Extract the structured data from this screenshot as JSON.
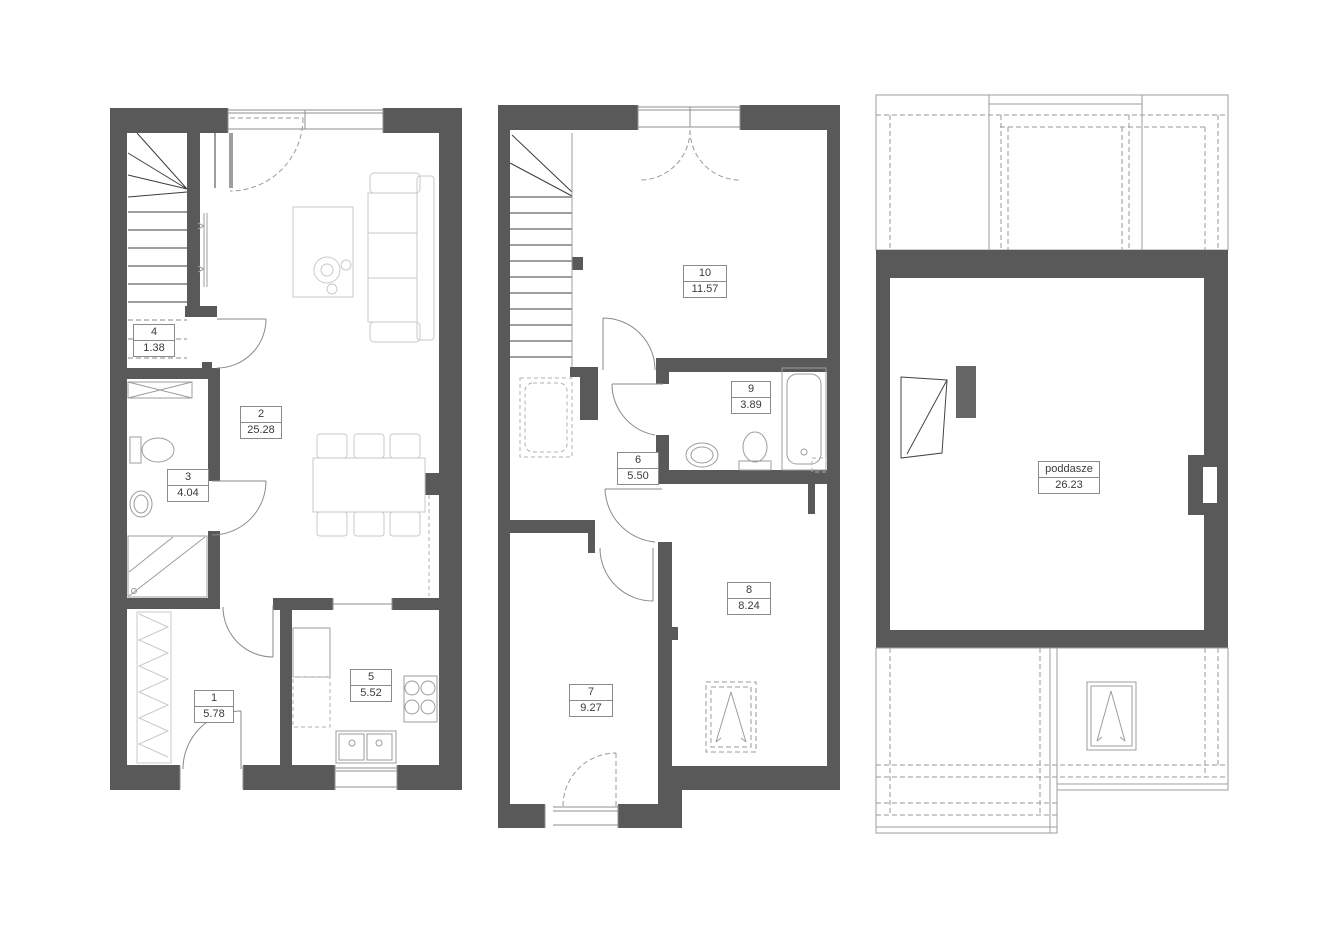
{
  "floors": {
    "ground": {
      "rooms": [
        {
          "id": "1",
          "area": "5.78"
        },
        {
          "id": "2",
          "area": "25.28"
        },
        {
          "id": "3",
          "area": "4.04"
        },
        {
          "id": "4",
          "area": "1.38"
        },
        {
          "id": "5",
          "area": "5.52"
        }
      ]
    },
    "first": {
      "rooms": [
        {
          "id": "6",
          "area": "5.50"
        },
        {
          "id": "7",
          "area": "9.27"
        },
        {
          "id": "8",
          "area": "8.24"
        },
        {
          "id": "9",
          "area": "3.89"
        },
        {
          "id": "10",
          "area": "11.57"
        }
      ]
    },
    "attic": {
      "rooms": [
        {
          "id": "poddasze",
          "area": "26.23"
        }
      ]
    }
  },
  "colors": {
    "wall": "#595959",
    "chimney": "#666666",
    "background": "#ffffff",
    "label_border": "#8a8a8a"
  }
}
